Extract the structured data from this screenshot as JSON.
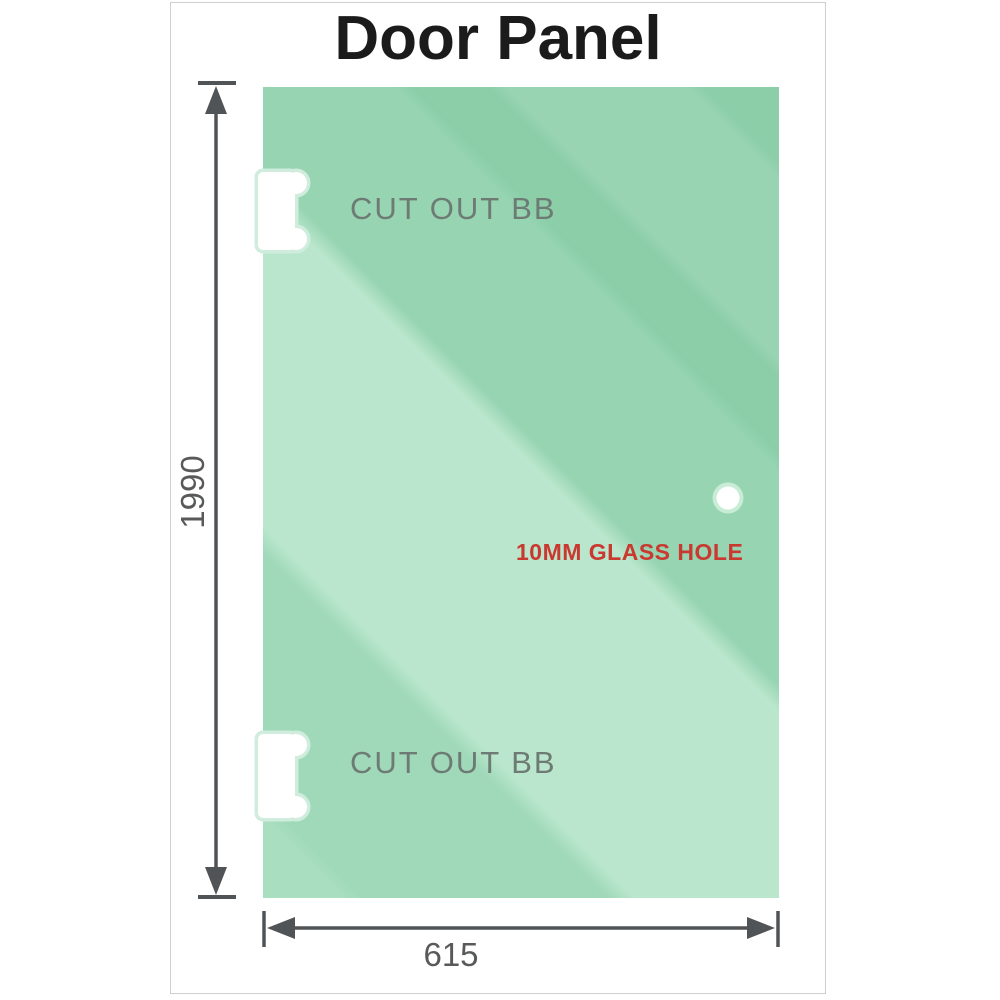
{
  "title": "Door Panel",
  "panel": {
    "cutout_top_label": "CUT OUT BB",
    "cutout_bottom_label": "CUT OUT BB",
    "glass_hole_label": "10MM GLASS HOLE"
  },
  "dimensions": {
    "height_label": "1990",
    "width_label": "615"
  },
  "colors": {
    "glass_base": "#8bcea8",
    "glass_light": "#b9e6cc",
    "cutout_halo": "#cfecdd",
    "hole_ring": "#c9ecd7",
    "accent_red": "#c9392f",
    "dimension_line": "#515457",
    "label_gray": "#58595b",
    "cutout_label_gray": "#6e7b74",
    "frame_border": "#cfcfcf",
    "title_color": "#1b1b1b"
  }
}
